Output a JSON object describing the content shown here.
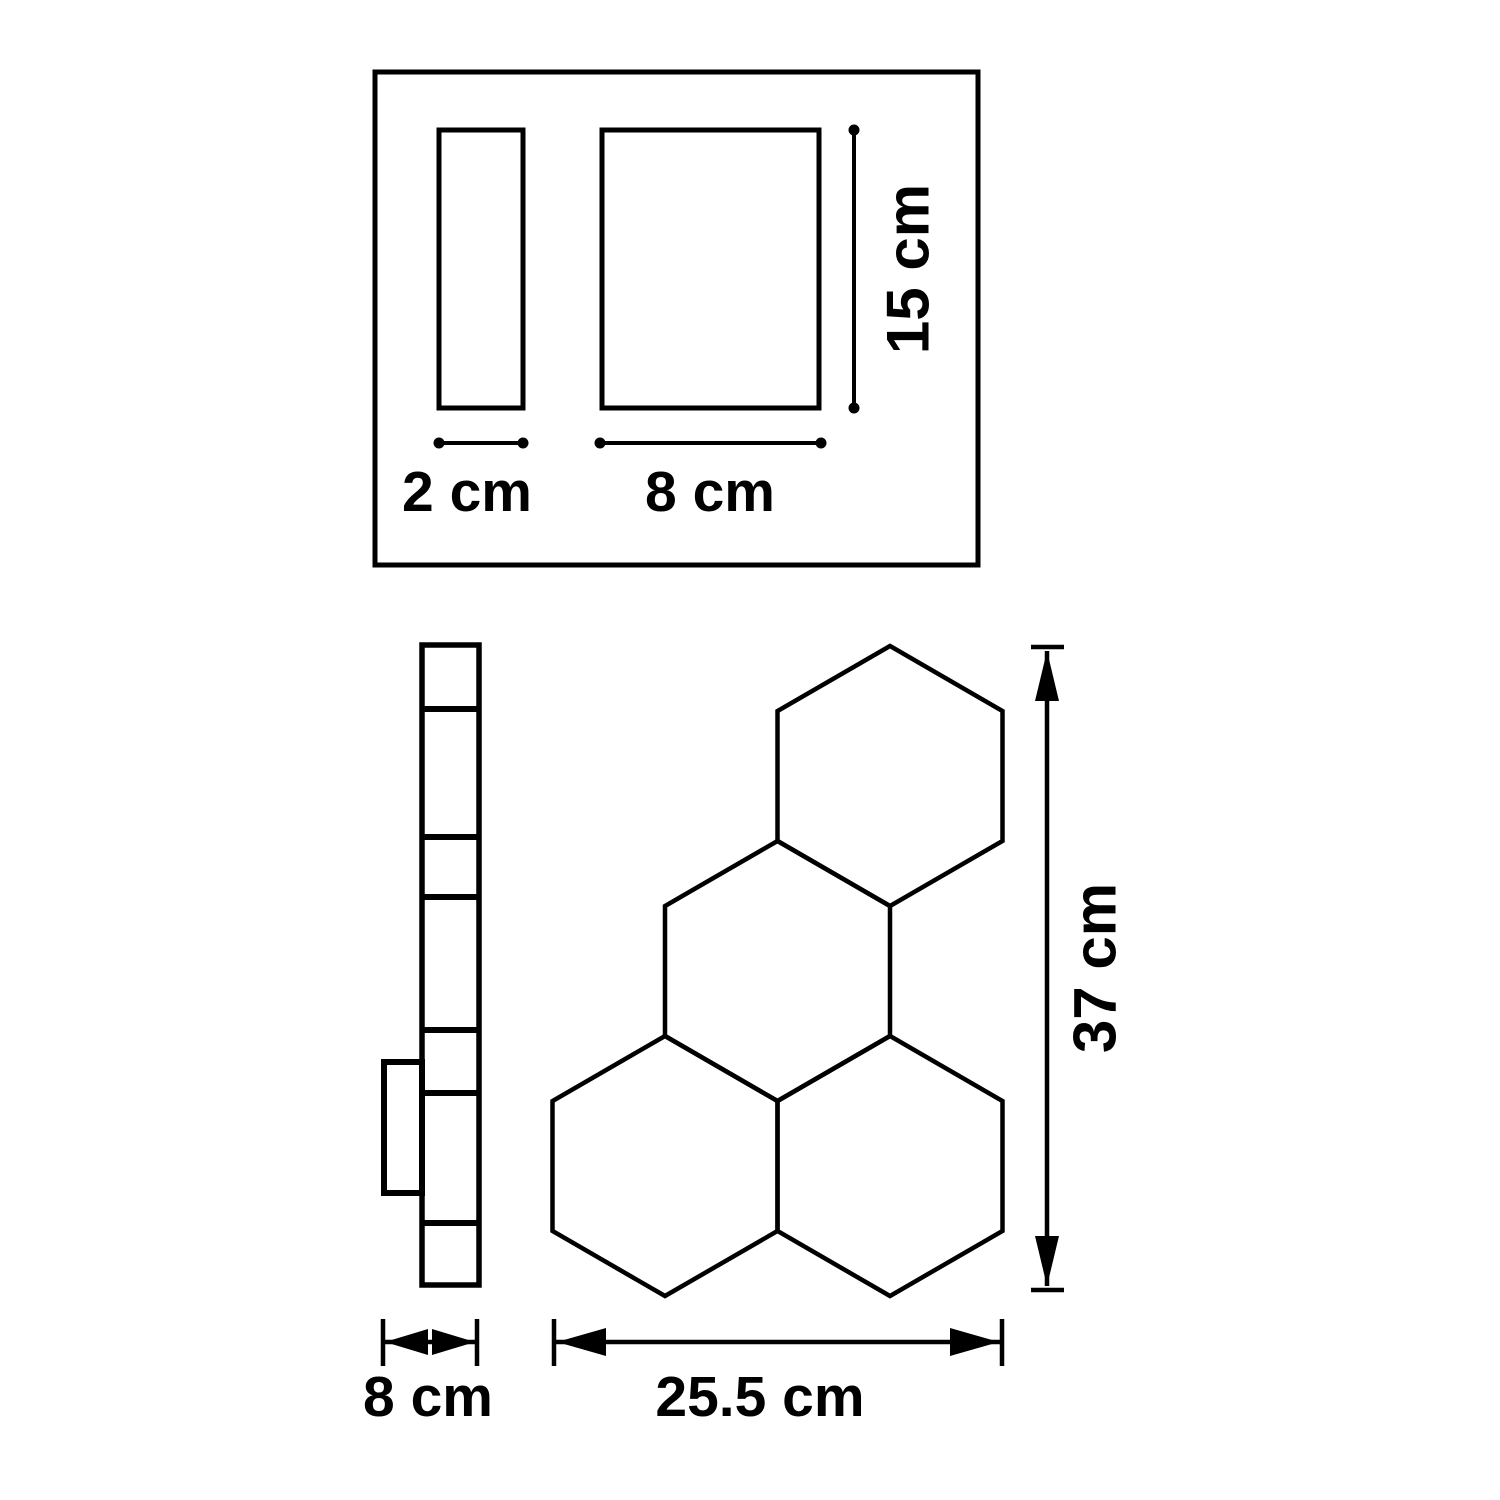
{
  "colors": {
    "line": "#000000",
    "background": "#ffffff"
  },
  "views": {
    "top_view": {
      "thickness_label": "2 cm",
      "width_label": "8 cm",
      "height_label": "15 cm"
    },
    "side_view": {
      "depth_label": "8 cm",
      "segment_count": 7
    },
    "front_view": {
      "width_label": "25.5 cm",
      "height_label": "37 cm",
      "hexagon_count": 4
    }
  }
}
